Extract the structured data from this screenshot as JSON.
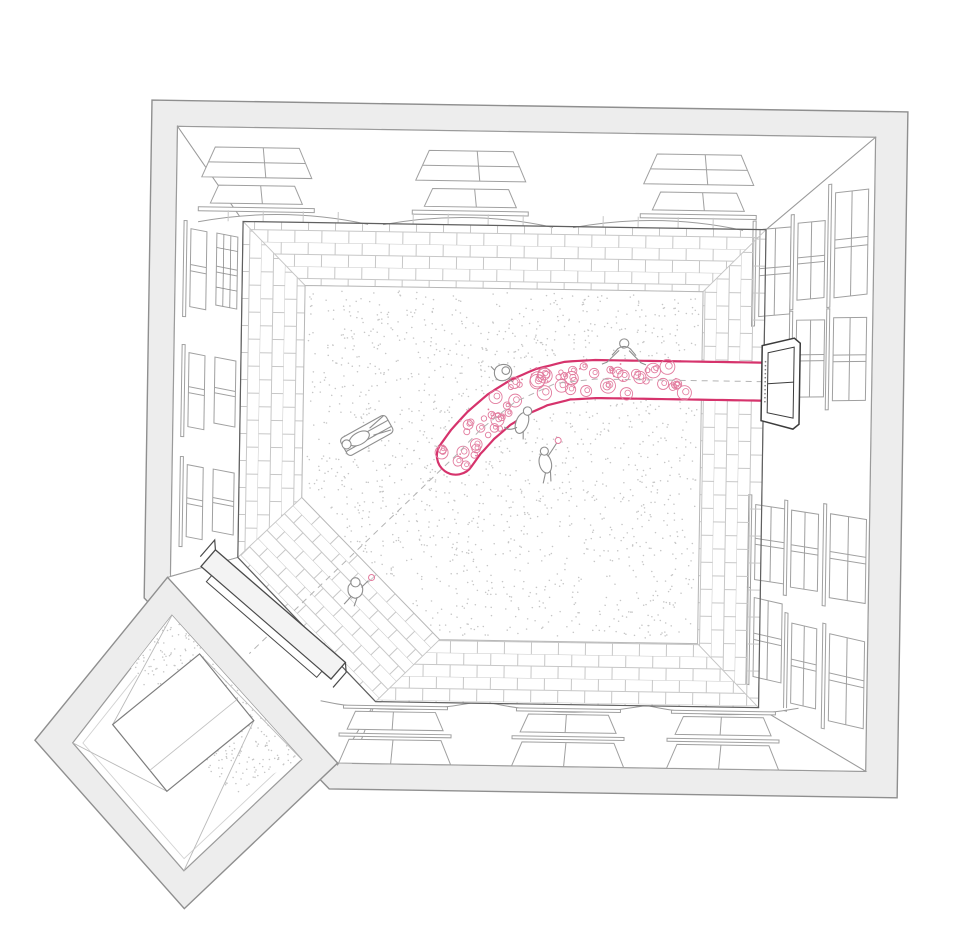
{
  "drawing": {
    "kind": "axonometric-courtyard-illustration",
    "palette": {
      "background": "#ffffff",
      "wall_fill": "#ededed",
      "wall_edge": "#8f8f8f",
      "facade_line": "#9c9c9c",
      "window_line": "#a0a0a0",
      "base_line": "#5f5f5f",
      "dark_line": "#3c3c3c",
      "brick_line": "#c7c7c7",
      "edging_line": "#b8b8b8",
      "stipple_dot": "#c6c6c6",
      "path_pink": "#d6336c",
      "flower_pink": "#e27b9e",
      "figure_line": "#8f8f8f",
      "dash_gray": "#b3b3b3",
      "step_fill": "#f3f3f3"
    },
    "flower_path": {
      "halfwidth": 19,
      "flower_count": 64
    },
    "stipple": {
      "main_dots": 1500,
      "annex_dots": 300
    },
    "seed": 11,
    "figures": [
      {
        "name": "person-on-lounger"
      },
      {
        "name": "person-sitting-on-paving-edge"
      },
      {
        "name": "person-sitting-at-path-edge"
      },
      {
        "name": "person-picking-flowers"
      },
      {
        "name": "person-walking-with-flower"
      },
      {
        "name": "person-crouching-at-path"
      },
      {
        "name": "person-crouching-in-annex"
      }
    ],
    "windows": {
      "left_rows": 3,
      "right_windows": 11,
      "top_clusters": 3,
      "bottom_clusters": 3
    }
  }
}
